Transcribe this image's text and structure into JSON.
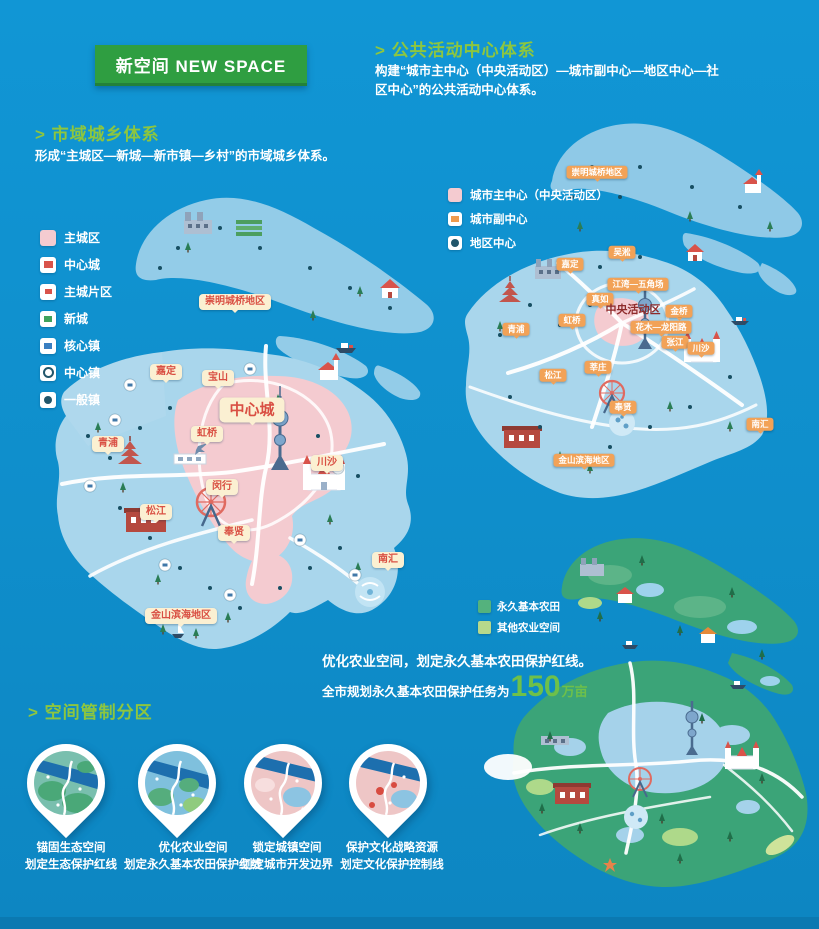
{
  "banner": {
    "title": "新空间 NEW SPACE"
  },
  "sections": {
    "urban_rural": {
      "heading": "> 市域城乡体系",
      "desc": "形成“主城区—新城—新市镇—乡村”的市域城乡体系。"
    },
    "public_centers": {
      "heading": "> 公共活动中心体系",
      "desc": "构建“城市主中心（中央活动区）—城市副中心—地区中心—社区中心”的公共活动中心体系。"
    },
    "zoning_heading": "> 空间管制分区"
  },
  "legends": {
    "left": [
      {
        "label": "主城区"
      },
      {
        "label": "中心城"
      },
      {
        "label": "主城片区"
      },
      {
        "label": "新城"
      },
      {
        "label": "核心镇"
      },
      {
        "label": "中心镇"
      },
      {
        "label": "一般镇"
      }
    ],
    "right": [
      {
        "label": "城市主中心（中央活动区）"
      },
      {
        "label": "城市副中心"
      },
      {
        "label": "地区中心"
      }
    ],
    "farm": [
      {
        "label": "永久基本农田"
      },
      {
        "label": "其他农业空间"
      }
    ]
  },
  "maps": {
    "left": {
      "labels": [
        "崇明城桥地区",
        "嘉定",
        "宝山",
        "中心城",
        "虹桥",
        "青浦",
        "川沙",
        "闵行",
        "松江",
        "奉贤",
        "南汇",
        "金山滨海地区"
      ]
    },
    "right": {
      "caz": "中央活动区",
      "labels": [
        "崇明城桥地区",
        "吴淞",
        "嘉定",
        "江湾—五角场",
        "真如",
        "虹桥",
        "金桥",
        "花木—龙阳路",
        "张江",
        "川沙",
        "莘庄",
        "松江",
        "青浦",
        "奉贤",
        "南汇",
        "金山滨海地区"
      ]
    }
  },
  "farm_note": {
    "line1": "优化农业空间，划定永久基本农田保护红线。",
    "line2_prefix": "全市规划永久基本农田保护任务为",
    "number": "150",
    "unit": "万亩"
  },
  "zoning": {
    "pins": [
      {
        "title": "锚固生态空间",
        "subtitle": "划定生态保护红线"
      },
      {
        "title": "优化农业空间",
        "subtitle": "划定永久基本农田保护红线"
      },
      {
        "title": "锁定城镇空间",
        "subtitle": "划定城市开发边界"
      },
      {
        "title": "保护文化战略资源",
        "subtitle": "划定文化保护控制线"
      }
    ]
  },
  "colors": {
    "accent_green": "#8dc63f",
    "banner_green": "#2f9e41",
    "number_green": "#6ec04a",
    "label_red": "#d94f43",
    "core_pink": "#f4cbd0",
    "background_blue": "#0f8ecb"
  }
}
